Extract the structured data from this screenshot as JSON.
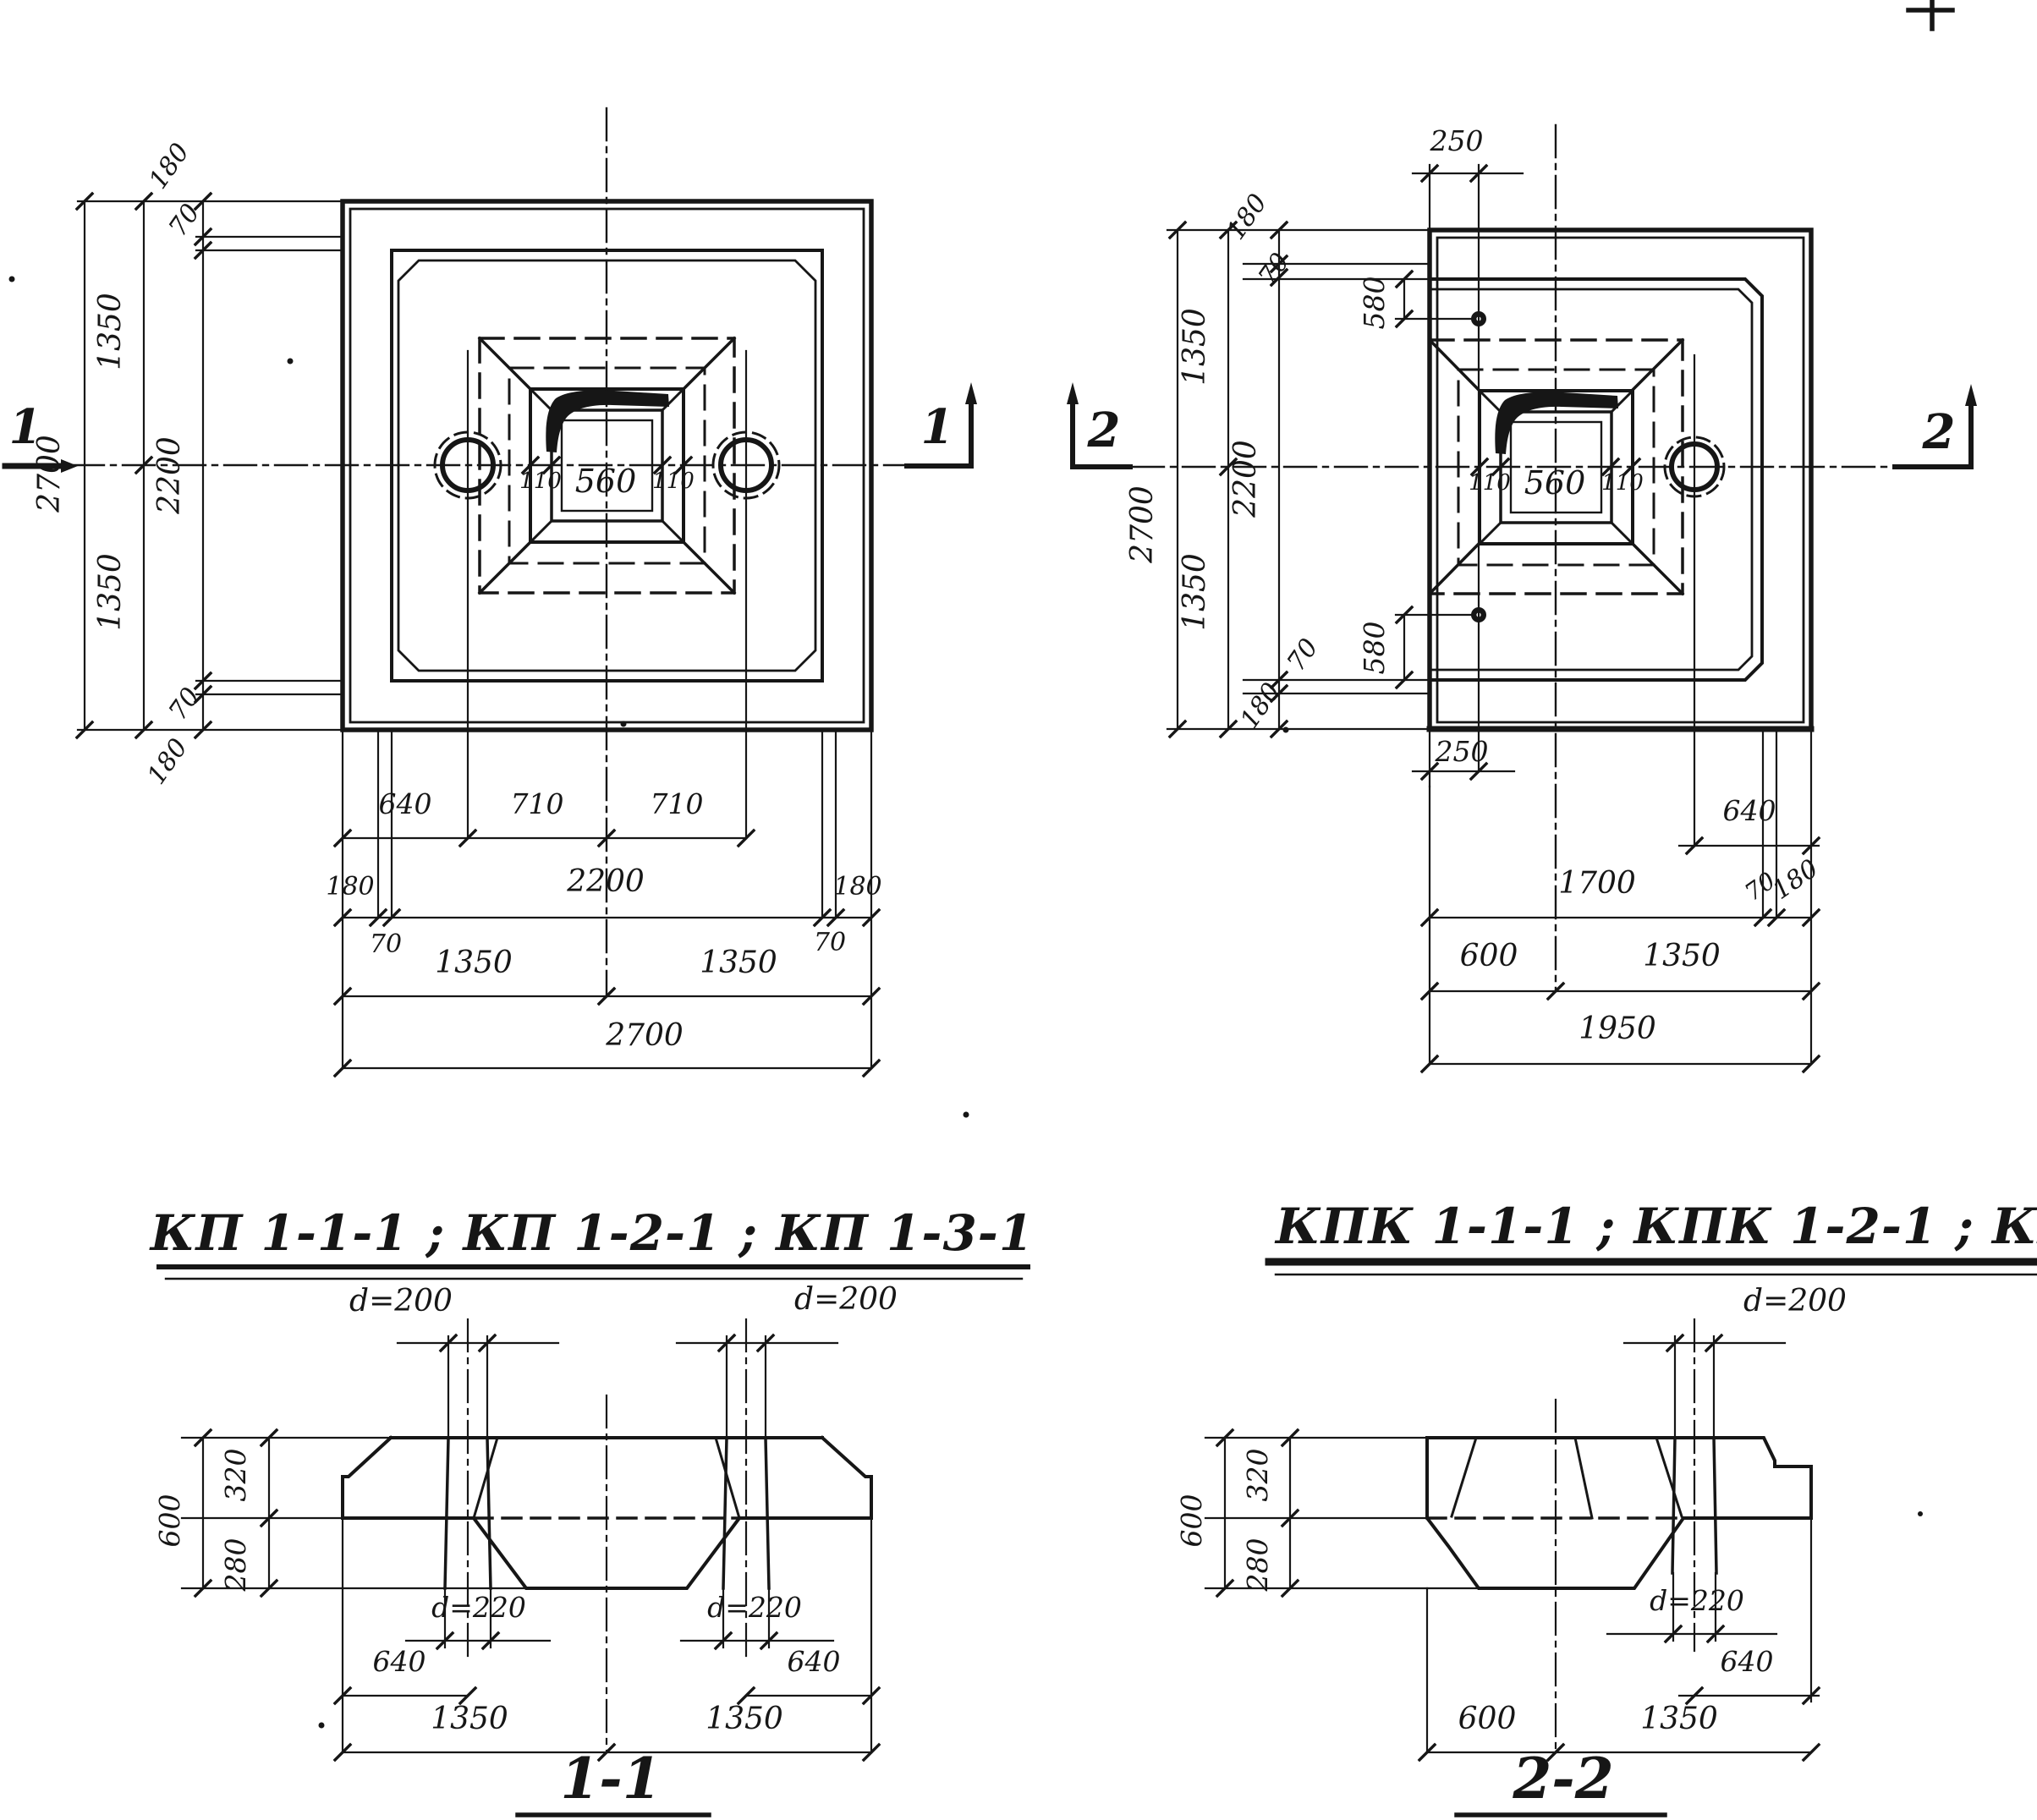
{
  "titles": {
    "left": "КП 1-1-1 ; КП 1-2-1 ; КП 1-3-1",
    "right": "КПК 1-1-1 ; КПК 1-2-1 ; КПК 1-3-1"
  },
  "plan_left": {
    "marker_left": "1",
    "marker_right": "1",
    "socket_dim_left": "110",
    "socket_dim_center": "560",
    "socket_dim_right": "110",
    "left_chain": {
      "seg_180_top": "180",
      "seg_70_top": "70",
      "half_top": "1350",
      "inner": "2200",
      "half_bottom": "1350",
      "seg_70_bottom": "70",
      "seg_180_bottom": "180",
      "total": "2700"
    },
    "bottom": {
      "c640": "640",
      "c710a": "710",
      "c710b": "710",
      "e180l": "180",
      "inner": "2200",
      "e180r": "180",
      "e70l": "70",
      "e70r": "70",
      "half_l": "1350",
      "half_r": "1350",
      "total": "2700"
    }
  },
  "plan_right": {
    "marker_left": "2",
    "marker_right": "2",
    "socket_dim_left": "110",
    "socket_dim_center": "560",
    "socket_dim_right": "110",
    "top_offset": "250",
    "bottom_offset": "250",
    "anchor_top": {
      "s180": "180",
      "s70": "70",
      "s580": "580"
    },
    "anchor_bottom": {
      "s70": "70",
      "s180": "180",
      "s580": "580"
    },
    "left_chain": {
      "half_top": "1350",
      "inner": "2200",
      "half_bottom": "1350",
      "total": "2700"
    },
    "bottom": {
      "c640": "640",
      "c1700": "1700",
      "c70": "70",
      "c180": "180",
      "c600": "600",
      "c1350": "1350",
      "total": "1950"
    }
  },
  "section_1": {
    "label": "1-1",
    "dia_top_left": "d=200",
    "dia_top_right": "d=200",
    "dia_bot_left": "d=220",
    "dia_bot_right": "d=220",
    "h_total": "600",
    "h_cap": "320",
    "h_base": "280",
    "b640l": "640",
    "b640r": "640",
    "b1350l": "1350",
    "b1350r": "1350"
  },
  "section_2": {
    "label": "2-2",
    "dia_top": "d=200",
    "dia_bot": "d=220",
    "h_total": "600",
    "h_cap": "320",
    "h_base": "280",
    "b640": "640",
    "b600": "600",
    "b1350": "1350"
  }
}
